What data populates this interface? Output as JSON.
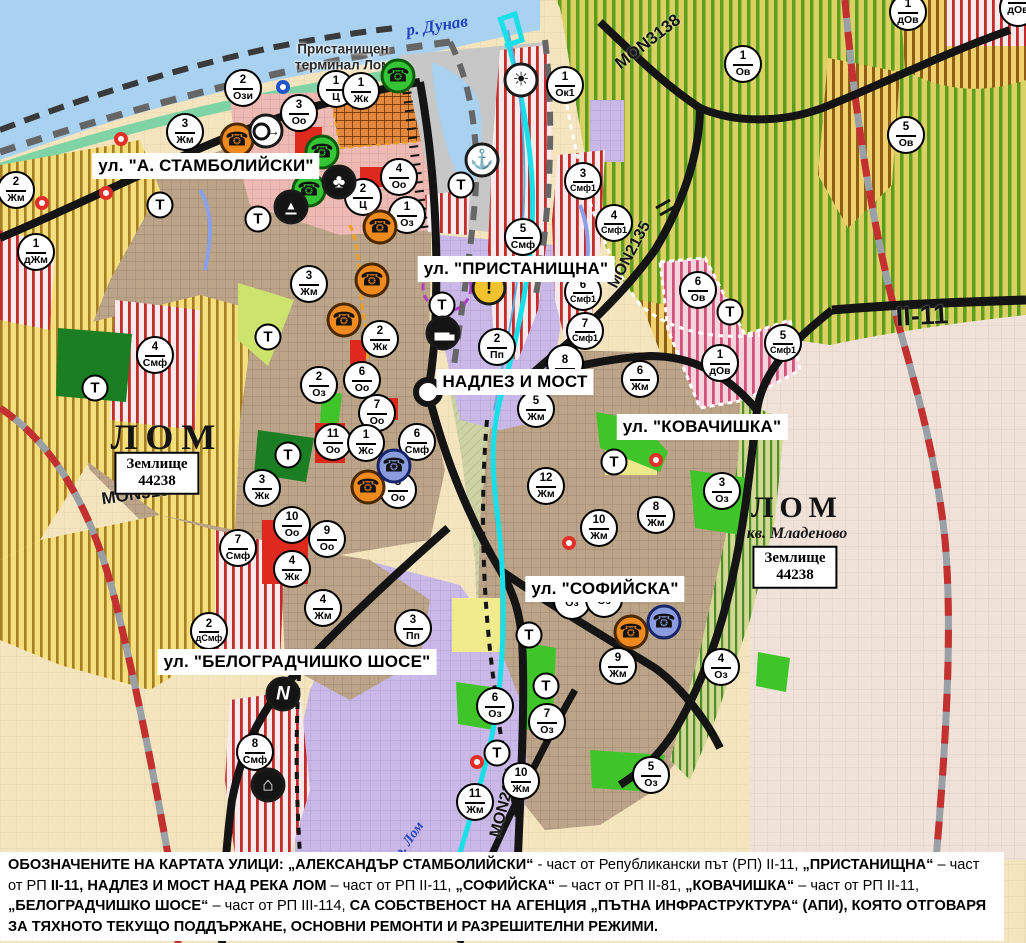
{
  "map": {
    "water_label": "р. Дунав",
    "port_terminal": {
      "line1": "Пристанищен",
      "line2": "терминал Лом"
    },
    "river_lom_label": "р. Лом",
    "city_labels": [
      {
        "name": "ЛОМ",
        "sub": ""
      },
      {
        "name": "ЛОМ",
        "sub": "кв. Младеново"
      }
    ],
    "land_registry_boxes": [
      {
        "line1": "Землище",
        "line2": "44238"
      },
      {
        "line1": "Землище",
        "line2": "44238"
      }
    ],
    "street_labels": [
      {
        "text": "ул. \"А. СТАМБОЛИЙСКИ\"",
        "x": 206,
        "y": 166
      },
      {
        "text": "ул. \"ПРИСТАНИЩНА\"",
        "x": 516,
        "y": 269
      },
      {
        "text": "НАДЛЕЗ И МОСТ",
        "x": 515,
        "y": 382
      },
      {
        "text": "ул. \"КОВАЧИШКА\"",
        "x": 702,
        "y": 427
      },
      {
        "text": "ул. \"СОФИЙСКА\"",
        "x": 605,
        "y": 589
      },
      {
        "text": "ул. \"БЕЛОГРАДЧИШКО ШОСЕ\"",
        "x": 297,
        "y": 662
      }
    ],
    "road_labels": [
      {
        "text": "MON3138",
        "x": 648,
        "y": 42,
        "rot": -38,
        "size": 17
      },
      {
        "text": "MON2135",
        "x": 630,
        "y": 255,
        "rot": -62,
        "size": 16
      },
      {
        "text": "II-11",
        "x": 922,
        "y": 316,
        "rot": -3,
        "size": 27
      },
      {
        "text": "MON3139",
        "x": 140,
        "y": 494,
        "rot": -8,
        "size": 17
      },
      {
        "text": "MON2136",
        "x": 505,
        "y": 802,
        "rot": -75,
        "size": 16
      }
    ],
    "markers": [
      {
        "n": "2",
        "l": "Жм",
        "x": 16,
        "y": 190
      },
      {
        "n": "1",
        "l": "дЖм",
        "x": 36,
        "y": 252
      },
      {
        "n": "3",
        "l": "Жм",
        "x": 185,
        "y": 132
      },
      {
        "n": "2",
        "l": "Ози",
        "x": 243,
        "y": 88
      },
      {
        "n": "1",
        "l": "Ц",
        "x": 336,
        "y": 89
      },
      {
        "n": "1",
        "l": "Жк",
        "x": 361,
        "y": 91
      },
      {
        "n": "3",
        "l": "Оо",
        "x": 299,
        "y": 113
      },
      {
        "n": "4",
        "l": "Оо",
        "x": 399,
        "y": 177
      },
      {
        "n": "2",
        "l": "Ц",
        "x": 363,
        "y": 197
      },
      {
        "n": "1",
        "l": "Оз",
        "x": 407,
        "y": 215
      },
      {
        "n": "4",
        "l": "Смф",
        "x": 155,
        "y": 355
      },
      {
        "n": "3",
        "l": "Жм",
        "x": 309,
        "y": 284
      },
      {
        "n": "2",
        "l": "Жк",
        "x": 380,
        "y": 339
      },
      {
        "n": "2",
        "l": "Оз",
        "x": 319,
        "y": 385
      },
      {
        "n": "6",
        "l": "Оо",
        "x": 362,
        "y": 380
      },
      {
        "n": "7",
        "l": "Оо",
        "x": 377,
        "y": 413
      },
      {
        "n": "11",
        "l": "Оо",
        "x": 333,
        "y": 442
      },
      {
        "n": "1",
        "l": "Жс",
        "x": 366,
        "y": 443
      },
      {
        "n": "6",
        "l": "Смф",
        "x": 417,
        "y": 442
      },
      {
        "n": "8",
        "l": "Оо",
        "x": 398,
        "y": 490
      },
      {
        "n": "3",
        "l": "Жк",
        "x": 262,
        "y": 488
      },
      {
        "n": "10",
        "l": "Оо",
        "x": 292,
        "y": 525
      },
      {
        "n": "9",
        "l": "Оо",
        "x": 327,
        "y": 539
      },
      {
        "n": "7",
        "l": "Смф",
        "x": 238,
        "y": 548
      },
      {
        "n": "4",
        "l": "Жк",
        "x": 292,
        "y": 569
      },
      {
        "n": "4",
        "l": "Жм",
        "x": 323,
        "y": 608
      },
      {
        "n": "2",
        "l": "дСмф",
        "x": 209,
        "y": 631
      },
      {
        "n": "3",
        "l": "Пп",
        "x": 413,
        "y": 628
      },
      {
        "n": "8",
        "l": "Смф",
        "x": 255,
        "y": 752
      },
      {
        "n": "2",
        "l": "Пп",
        "x": 497,
        "y": 347
      },
      {
        "n": "8",
        "l": "",
        "x": 565,
        "y": 363
      },
      {
        "n": "5",
        "l": "Жм",
        "x": 536,
        "y": 409
      },
      {
        "n": "12",
        "l": "Жм",
        "x": 546,
        "y": 486
      },
      {
        "n": "6",
        "l": "Жм",
        "x": 640,
        "y": 379
      },
      {
        "n": "10",
        "l": "Жм",
        "x": 599,
        "y": 528
      },
      {
        "n": "8",
        "l": "Жм",
        "x": 656,
        "y": 515
      },
      {
        "n": "3",
        "l": "Оз",
        "x": 722,
        "y": 491
      },
      {
        "n": "5",
        "l": "Смф",
        "x": 523,
        "y": 237
      },
      {
        "n": "3",
        "l": "Смф1",
        "x": 583,
        "y": 181
      },
      {
        "n": "4",
        "l": "Смф1",
        "x": 614,
        "y": 223
      },
      {
        "n": "6",
        "l": "Смф1",
        "x": 583,
        "y": 292
      },
      {
        "n": "7",
        "l": "Смф1",
        "x": 585,
        "y": 331
      },
      {
        "n": "1",
        "l": "Ок1",
        "x": 565,
        "y": 85
      },
      {
        "n": "1",
        "l": "Ов",
        "x": 743,
        "y": 64
      },
      {
        "n": "5",
        "l": "Ов",
        "x": 906,
        "y": 135
      },
      {
        "n": "1",
        "l": "дОв",
        "x": 908,
        "y": 12
      },
      {
        "n": "",
        "l": "дОв",
        "x": 1018,
        "y": 8
      },
      {
        "n": "6",
        "l": "Ов",
        "x": 698,
        "y": 290
      },
      {
        "n": "5",
        "l": "Смф1",
        "x": 783,
        "y": 343
      },
      {
        "n": "1",
        "l": "дОв",
        "x": 720,
        "y": 363
      },
      {
        "n": "6",
        "l": "Оз",
        "x": 495,
        "y": 706
      },
      {
        "n": "11",
        "l": "Жм",
        "x": 475,
        "y": 802
      },
      {
        "n": "10",
        "l": "Жм",
        "x": 521,
        "y": 781
      },
      {
        "n": "7",
        "l": "Оз",
        "x": 547,
        "y": 722
      },
      {
        "n": "9",
        "l": "Жм",
        "x": 618,
        "y": 666
      },
      {
        "n": "4",
        "l": "Оз",
        "x": 721,
        "y": 667
      },
      {
        "n": "5",
        "l": "Оз",
        "x": 651,
        "y": 775
      },
      {
        "n": "",
        "l": "Оз",
        "x": 572,
        "y": 601
      },
      {
        "n": "",
        "l": "Оз",
        "x": 604,
        "y": 599
      }
    ],
    "t_markers": [
      {
        "x": 160,
        "y": 205
      },
      {
        "x": 258,
        "y": 219
      },
      {
        "x": 442,
        "y": 305
      },
      {
        "x": 461,
        "y": 185
      },
      {
        "x": 95,
        "y": 388
      },
      {
        "x": 268,
        "y": 337
      },
      {
        "x": 288,
        "y": 455
      },
      {
        "x": 529,
        "y": 635
      },
      {
        "x": 546,
        "y": 686
      },
      {
        "x": 497,
        "y": 753
      },
      {
        "x": 614,
        "y": 462
      },
      {
        "x": 730,
        "y": 312
      }
    ],
    "t_label": "Т",
    "icon_markers": [
      {
        "type": "phone-green",
        "x": 398,
        "y": 76
      },
      {
        "type": "phone-green",
        "x": 322,
        "y": 152
      },
      {
        "type": "phone-green",
        "x": 309,
        "y": 190
      },
      {
        "type": "phone-orange",
        "x": 237,
        "y": 140
      },
      {
        "type": "phone-orange",
        "x": 380,
        "y": 227
      },
      {
        "type": "phone-orange",
        "x": 372,
        "y": 280
      },
      {
        "type": "phone-orange",
        "x": 344,
        "y": 320
      },
      {
        "type": "phone-orange",
        "x": 368,
        "y": 487
      },
      {
        "type": "phone-orange",
        "x": 631,
        "y": 632
      },
      {
        "type": "phone-blue",
        "x": 394,
        "y": 466
      },
      {
        "type": "phone-blue",
        "x": 664,
        "y": 622
      },
      {
        "type": "ring-arrow",
        "x": 266,
        "y": 131
      },
      {
        "type": "trefoil",
        "x": 339,
        "y": 182
      },
      {
        "type": "tunnel",
        "x": 291,
        "y": 207
      },
      {
        "type": "sun",
        "x": 521,
        "y": 80
      },
      {
        "type": "anchor",
        "x": 482,
        "y": 160
      },
      {
        "type": "truck",
        "x": 443,
        "y": 333
      },
      {
        "type": "warning",
        "x": 489,
        "y": 288
      },
      {
        "type": "lightning",
        "x": 283,
        "y": 694
      },
      {
        "type": "factory",
        "x": 268,
        "y": 785
      }
    ],
    "warning_glyph": "!",
    "dots": [
      {
        "c": "red",
        "x": 121,
        "y": 139
      },
      {
        "c": "red",
        "x": 106,
        "y": 193
      },
      {
        "c": "red",
        "x": 42,
        "y": 203
      },
      {
        "c": "red",
        "x": 656,
        "y": 460
      },
      {
        "c": "red",
        "x": 477,
        "y": 762
      },
      {
        "c": "red",
        "x": 569,
        "y": 543
      },
      {
        "c": "blue",
        "x": 283,
        "y": 87
      }
    ],
    "palette": {
      "water": "#A9D1F0",
      "farmland_yellow": "#F5DF7C",
      "farmland_stripe": "#A87E22",
      "orchard_stripe": "#5E9E1E",
      "urban_brown": "#BCA488",
      "public_purple": "#C9B8E8",
      "mixed_red_stripe": "#C62A2A",
      "park_green": "#3FC52A",
      "road_black": "#141414",
      "railway_red": "#C23030",
      "river_cyan": "#19E0E8",
      "port_grey": "#C7C7C7"
    }
  },
  "caption": {
    "segments": [
      {
        "t": "ОБОЗНАЧЕНИТЕ НА КАРТАТА УЛИЦИ: „АЛЕКСАНДЪР СТАМБОЛИЙСКИ“",
        "b": true
      },
      {
        "t": " - част от Републикански път (РП) II-11, ",
        "b": false
      },
      {
        "t": "„ПРИСТАНИЩНА“",
        "b": true
      },
      {
        "t": " – част от РП ",
        "b": false
      },
      {
        "t": "II-11, НАДЛЕЗ И МОСТ НАД РЕКА ЛОМ",
        "b": true
      },
      {
        "t": " – част от РП II-11, ",
        "b": false
      },
      {
        "t": "„СОФИЙСКА“",
        "b": true
      },
      {
        "t": " – част от РП II-81, ",
        "b": false
      },
      {
        "t": "„КОВАЧИШКА“",
        "b": true
      },
      {
        "t": " – част от РП II-11, ",
        "b": false
      },
      {
        "t": "„БЕЛОГРАДЧИШКО ШОСЕ“",
        "b": true
      },
      {
        "t": " – част от РП III-114, ",
        "b": false
      },
      {
        "t": "СА СОБСТВЕНОСТ НА АГЕНЦИЯ „ПЪТНА ИНФРАСТРУКТУРА“ (АПИ), КОЯТО ОТГОВАРЯ ЗА ТЯХНОТО ТЕКУЩО ПОДДЪРЖАНЕ, ОСНОВНИ РЕМОНТИ И РАЗРЕШИТЕЛНИ РЕЖИМИ.",
        "b": true
      }
    ]
  }
}
